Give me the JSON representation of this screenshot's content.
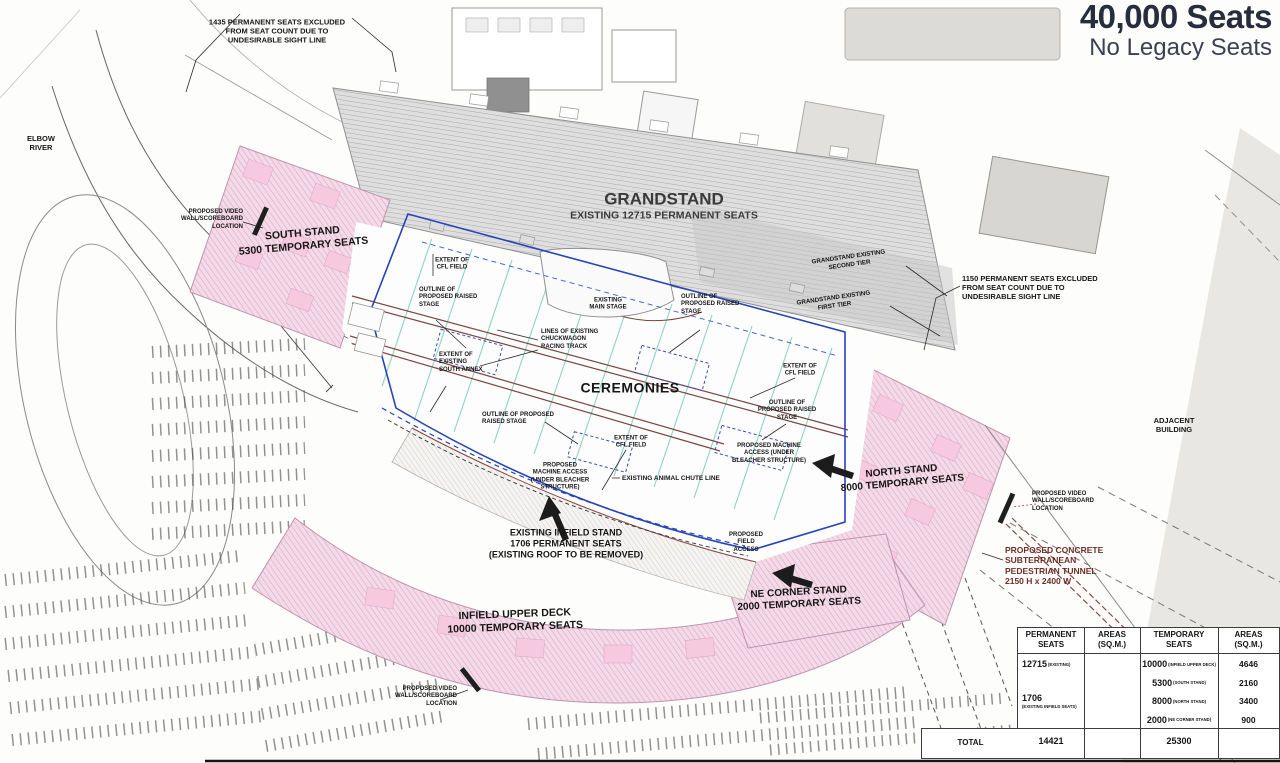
{
  "title": {
    "seats": "40,000 Seats",
    "subtitle": "No Legacy Seats"
  },
  "labels": {
    "excluded_1435": "1435 PERMANENT SEATS EXCLUDED\nFROM SEAT COUNT DUE TO\nUNDESIRABLE SIGHT LINE",
    "elbow_river": "ELBOW\nRIVER",
    "video_wall_west": "PROPOSED VIDEO\nWALL/SCOREBOARD\nLOCATION",
    "south_stand": "SOUTH STAND\n5300 TEMPORARY SEATS",
    "grandstand_title": "GRANDSTAND",
    "grandstand_subtitle": "EXISTING 12715 PERMANENT SEATS",
    "grandstand_second_tier": "GRANDSTAND EXISTING\nSECOND TIER",
    "grandstand_first_tier": "GRANDSTAND EXISTING\nFIRST TIER",
    "excluded_1150": "1150 PERMANENT SEATS EXCLUDED\nFROM SEAT COUNT DUE TO\nUNDESIRABLE SIGHT LINE",
    "extent_cfl_north": "EXTENT OF\nCFL FIELD",
    "outline_stage_west": "OUTLINE OF\nPROPOSED RAISED\nSTAGE",
    "existing_main_stage": "EXISTING\nMAIN STAGE",
    "outline_stage_north": "OUTLINE OF\nPROPOSED RAISED\nSTAGE",
    "chuckwagon": "LINES OF EXISTING\nCHUCKWAGON\nRACING TRACK",
    "south_annex": "EXTENT OF\nEXISTING\nSOUTH ANNEX",
    "ceremonies": "CEREMONIES",
    "extent_cfl_east": "EXTENT OF\nCFL FIELD",
    "outline_stage_east": "OUTLINE OF\nPROPOSED RAISED\nSTAGE",
    "outline_stage_south": "OUTLINE OF PROPOSED\nRAISED STAGE",
    "machine_access_south": "PROPOSED\nMACHINE ACCESS\n(UNDER BLEACHER\nSTRUCTURE)",
    "extent_cfl_south": "EXTENT OF\nCFL FIELD",
    "machine_access_east": "PROPOSED MACHINE\nACCESS (UNDER\nBLEACHER STRUCTURE)",
    "animal_chute": "EXISTING ANIMAL CHUTE LINE",
    "field_access": "PROPOSED\nFIELD\nACCESS",
    "infield_stand": "EXISTING INFIELD STAND\n1706 PERMANENT SEATS\n(EXISTING ROOF TO BE REMOVED)",
    "north_stand": "NORTH STAND\n8000 TEMPORARY SEATS",
    "adjacent_building": "ADJACENT\nBUILDING",
    "video_wall_east": "PROPOSED VIDEO\nWALL/SCOREBOARD\nLOCATION",
    "pedestrian_tunnel": "PROPOSED CONCRETE\nSUBTERRANEAN\nPEDESTRIAN TUNNEL\n2150 H x 2400 W",
    "ne_corner_stand": "NE CORNER STAND\n2000 TEMPORARY SEATS",
    "infield_upper_deck": "INFIELD UPPER DECK\n10000 TEMPORARY SEATS",
    "video_wall_south": "PROPOSED VIDEO\nWALL/SCOREBOARD\nLOCATION"
  },
  "table": {
    "headers": [
      "PERMANENT\nSEATS",
      "AREAS\n(SQ.M.)",
      "TEMPORARY\nSEATS",
      "AREAS\n(SQ.M.)"
    ],
    "permanent": [
      {
        "value": "12715",
        "note": "(EXISTING)"
      },
      {
        "value": "1706",
        "note": "(EXISTING INFIELD SEATS)"
      }
    ],
    "temporary": [
      {
        "value": "10000",
        "note": "(INFIELD UPPER DECK)",
        "area": "4646"
      },
      {
        "value": "5300",
        "note": "(SOUTH STAND)",
        "area": "2160"
      },
      {
        "value": "8000",
        "note": "(NORTH STAND)",
        "area": "3400"
      },
      {
        "value": "2000",
        "note": "(NE CORNER STAND)",
        "area": "900"
      }
    ],
    "total_label": "TOTAL",
    "total_permanent": "14421",
    "total_temporary": "25300"
  },
  "colors": {
    "stand_pink": "#f4d9e6",
    "stand_hatch": "#d6a3c3",
    "grandstand_gray": "#dedede",
    "cfl_blue": "#2744b8",
    "track_maroon": "#7b453e",
    "teal_line": "#8ed3c6",
    "title_navy": "#262d3d",
    "tunnel_maroon": "#6d2f2b"
  }
}
